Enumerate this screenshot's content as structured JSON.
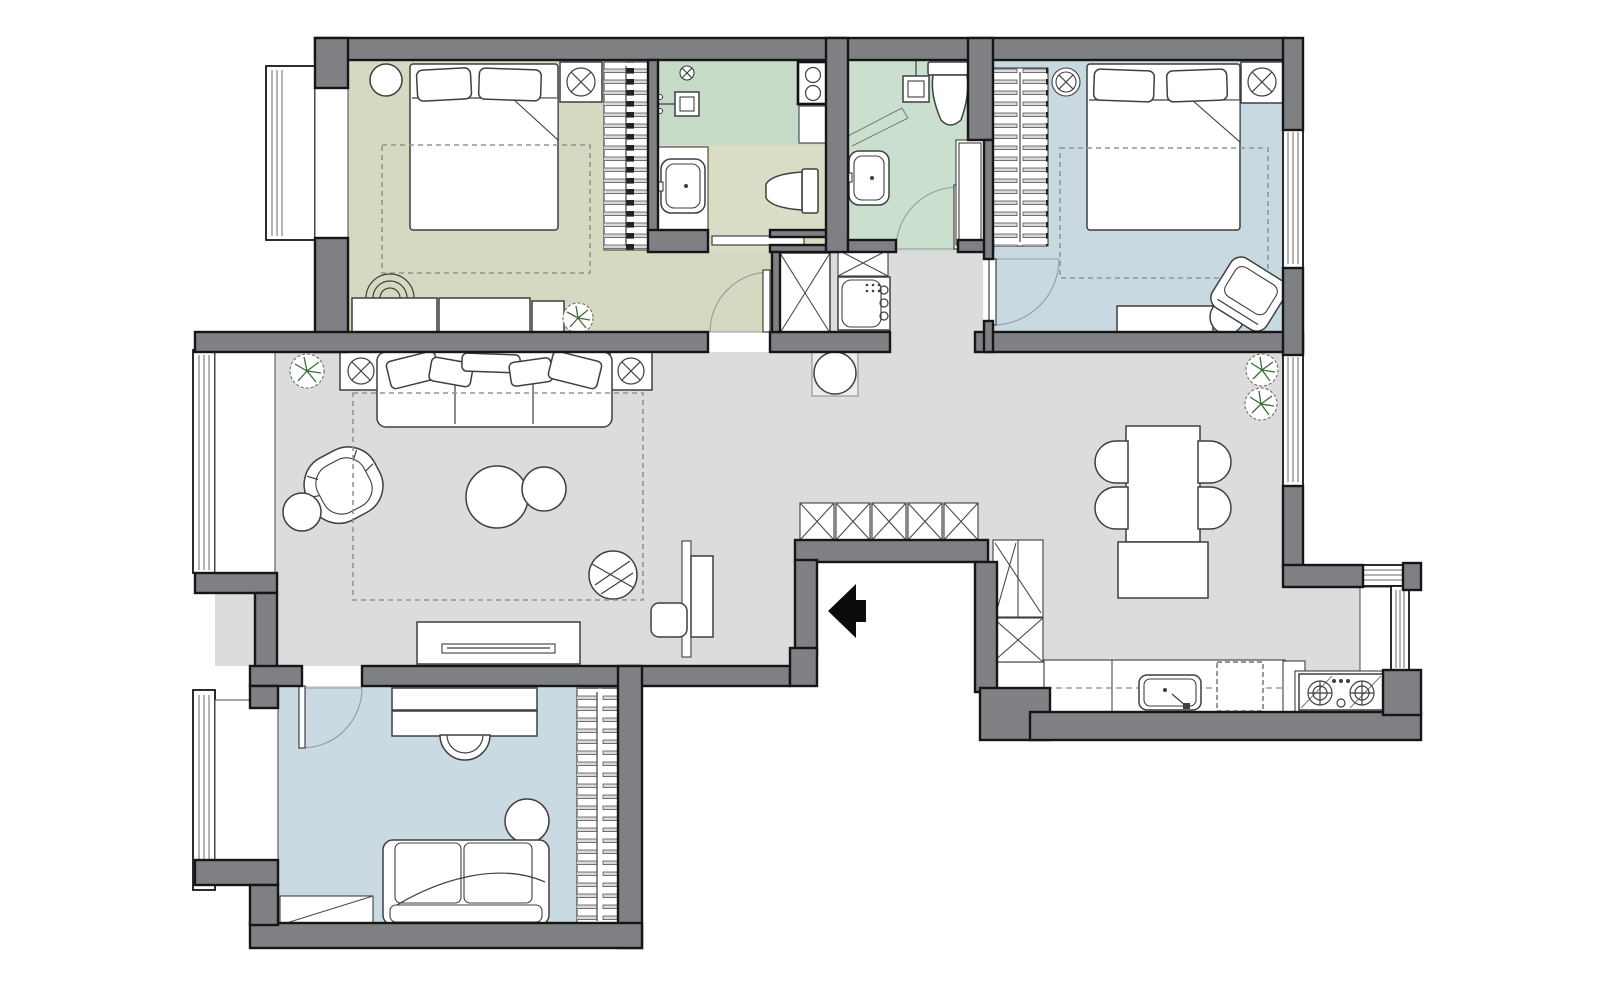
{
  "plan": {
    "type": "apartment-floor-plan",
    "view": "top-down",
    "text_labels_visible": false
  },
  "colors": {
    "background": "#ffffff",
    "wall": "#7e8084",
    "wall_outline": "#161616",
    "hall_floor": "#dcdcdc",
    "bedroom1_floor": "#d6d8c1",
    "bedroom2_floor": "#c8d9e2",
    "study_floor": "#c9dae2",
    "bath1_shower_floor": "#c5dbc8",
    "bath1_floor": "#dadcc5",
    "bath2_floor": "#cadfcd",
    "furniture_fill": "#ffffff",
    "furniture_line": "#3f3f3f",
    "rug_line": "#949494",
    "plant_green": "#3c6b38",
    "entry_arrow": "#0c0c0c",
    "hanger_bar": "#d9d9d9"
  },
  "rooms": [
    {
      "id": "bedroom-1",
      "position": "top-left",
      "floor": "olive",
      "furniture": [
        "double-bed",
        "two-pillows",
        "round-nightstand",
        "ceiling-lamp",
        "wardrobe-with-hangers",
        "rug",
        "table-lamp",
        "low-dresser",
        "plant"
      ]
    },
    {
      "id": "bathroom-1",
      "position": "top-middle",
      "floor": "green-olive",
      "furniture": [
        "shower-head",
        "ceiling-lamp",
        "washer-column",
        "shelf",
        "sink-counter",
        "sink",
        "toilet",
        "pocket-sliding-door"
      ]
    },
    {
      "id": "bathroom-2",
      "position": "top-middle-right",
      "floor": "green",
      "furniture": [
        "shower-head",
        "shower-glass",
        "toilet",
        "sink",
        "storage-column",
        "swing-door"
      ]
    },
    {
      "id": "bedroom-2",
      "position": "top-right",
      "floor": "blue",
      "furniture": [
        "double-bed",
        "two-pillows",
        "wardrobe-with-hangers",
        "round-ceiling-lamp",
        "ceiling-lamp",
        "rug",
        "tv-stand",
        "armchair",
        "round-side-table",
        "window",
        "swing-door"
      ]
    },
    {
      "id": "living-room",
      "position": "center-left",
      "floor": "gray",
      "furniture": [
        "three-seat-sofa",
        "five-pillows",
        "two-ceiling-lamps",
        "plant",
        "tub-armchair",
        "ball-side-table",
        "two-round-coffee-tables",
        "striped-pouf",
        "rug",
        "tv-console",
        "desk-panel",
        "desk-chair",
        "window-bay"
      ]
    },
    {
      "id": "hallway-entry",
      "position": "center",
      "floor": "gray",
      "furniture": [
        "closet",
        "appliance-column",
        "round-table-on-mat",
        "five-entry-closets",
        "entry-arrow",
        "corridor-cabinet"
      ]
    },
    {
      "id": "kitchen-dining",
      "position": "right",
      "floor": "gray",
      "furniture": [
        "dining-table",
        "four-chairs",
        "sideboard",
        "two-plants",
        "tall-larder-cabinet",
        "closet-box",
        "base-cabinet",
        "kitchen-sink",
        "dishwasher-dashed",
        "tall-unit",
        "gas-stove",
        "bay-window",
        "window"
      ]
    },
    {
      "id": "study",
      "position": "bottom-left",
      "floor": "blue",
      "furniture": [
        "desk",
        "desk-chair",
        "round-table",
        "two-seat-sofa",
        "wardrobe-with-hangers",
        "corner-shelf",
        "window-bay",
        "swing-door"
      ]
    }
  ],
  "door_count": 6,
  "window_count": 6,
  "entry": {
    "marker": "black-arrow",
    "direction": "left"
  }
}
